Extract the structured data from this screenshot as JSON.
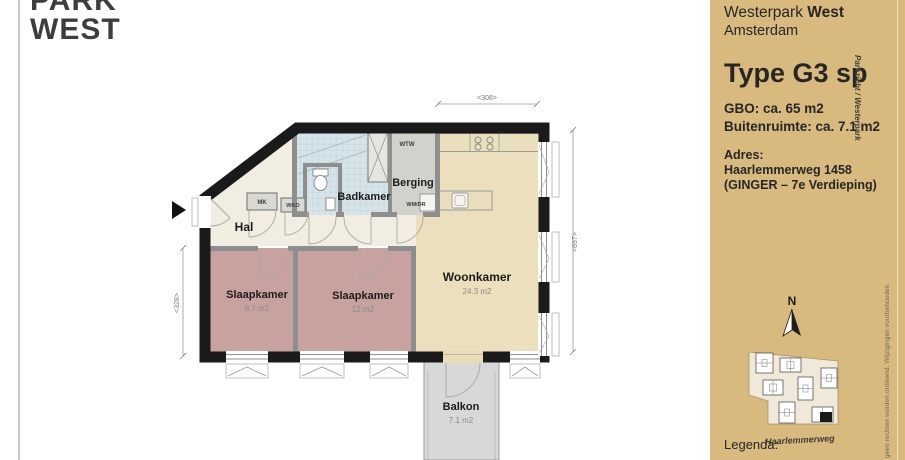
{
  "logo": {
    "line1": "PARK",
    "line2": "WEST"
  },
  "sidebar": {
    "project_name_regular": "Westerpark ",
    "project_name_bold": "West",
    "city": "Amsterdam",
    "type_title": "Type G3 sp",
    "gbo_line": "GBO: ca. 65 m2",
    "outdoor_line": "Buitenruimte: ca. 7.1 m2",
    "address_label": "Adres:",
    "address_street": "Haarlemmerweg 1458",
    "address_detail": "(GINGER – 7e Verdieping)",
    "compass_n": "N",
    "map_street_label": "Haarlemmerweg",
    "map_side_label": "Parkzicht / Westerpark",
    "disclaimer_vertical": "geen rechten worden ontleend. Wijzigingen voorbehouden.",
    "legend_label": "Legenda:"
  },
  "floorplan": {
    "rooms": {
      "hal": {
        "name": "Hal"
      },
      "badkamer": {
        "name": "Badkamer"
      },
      "berging": {
        "name": "Berging"
      },
      "slaapkamer1": {
        "name": "Slaapkamer",
        "area": "8.7 m2"
      },
      "slaapkamer2": {
        "name": "Slaapkamer",
        "area": "12 m2"
      },
      "woonkamer": {
        "name": "Woonkamer",
        "area": "24.3 m2"
      },
      "balkon": {
        "name": "Balkon",
        "area": "7.1 m2"
      }
    },
    "fixtures": {
      "mk": "MK",
      "wko": "WKO",
      "wtw": "WTW",
      "wmdr": "WM/DR"
    },
    "dimensions": {
      "top": "<308>",
      "right": "<697>",
      "left": "<328>"
    }
  },
  "colors": {
    "sidebar-bg": "#d8b97e",
    "wall": "#1a1a1a",
    "hal": "#f2ede1",
    "woon": "#ecdfbd",
    "mauve": "#c8a29e",
    "tile": "#d6e4ea",
    "grayroom": "#d1d2cc",
    "balkon": "#d8d8d8"
  }
}
